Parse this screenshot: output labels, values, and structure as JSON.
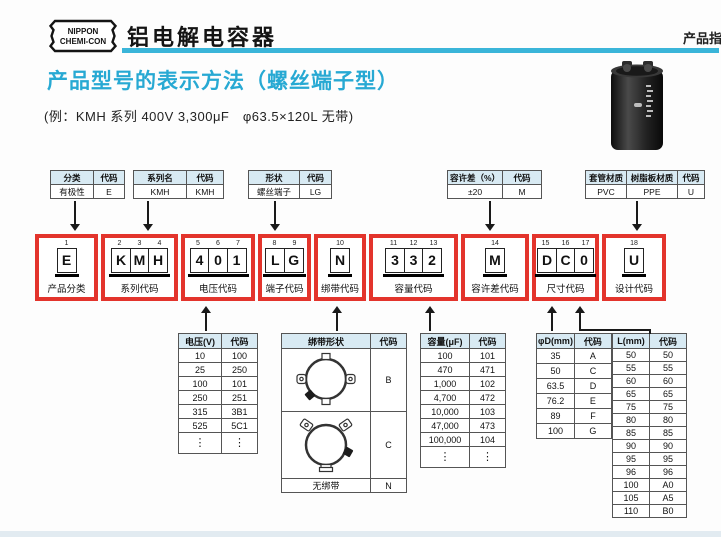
{
  "header": {
    "logo_line1": "NIPPON",
    "logo_line2": "CHEMI-CON",
    "title": "铝电解电容器",
    "corner_text": "产品指"
  },
  "section": {
    "title": "产品型号的表示方法（螺丝端子型）",
    "example": "(例：KMH 系列 400V 3,300μF　φ63.5×120L 无带)"
  },
  "colors": {
    "accent_teal": "#3ab5d9",
    "title_cyan": "#27a9d3",
    "code_box_red": "#e3342c",
    "table_header_bg": "#d8eaf3"
  },
  "attr_tables": [
    {
      "headers": [
        "分类",
        "代码"
      ],
      "rows": [
        [
          "有极性",
          "E"
        ]
      ]
    },
    {
      "headers": [
        "系列名",
        "代码"
      ],
      "rows": [
        [
          "KMH",
          "KMH"
        ]
      ]
    },
    {
      "headers": [
        "形状",
        "代码"
      ],
      "rows": [
        [
          "螺丝端子",
          "LG"
        ]
      ]
    },
    {
      "headers": [
        "容许差（%）",
        "代码"
      ],
      "rows": [
        [
          "±20",
          "M"
        ]
      ]
    },
    {
      "headers": [
        "套管材质",
        "树脂板材质",
        "代码"
      ],
      "rows": [
        [
          "PVC",
          "PPE",
          "U"
        ]
      ]
    }
  ],
  "code_boxes": [
    {
      "positions": [
        "1"
      ],
      "chars": [
        "E"
      ],
      "label": "产品分类"
    },
    {
      "positions": [
        "2",
        "3",
        "4"
      ],
      "chars": [
        "K",
        "M",
        "H"
      ],
      "label": "系列代码"
    },
    {
      "positions": [
        "5",
        "6",
        "7"
      ],
      "chars": [
        "4",
        "0",
        "1"
      ],
      "label": "电压代码"
    },
    {
      "positions": [
        "8",
        "9"
      ],
      "chars": [
        "L",
        "G"
      ],
      "label": "端子代码"
    },
    {
      "positions": [
        "10"
      ],
      "chars": [
        "N"
      ],
      "label": "绑带代码"
    },
    {
      "positions": [
        "11",
        "12",
        "13"
      ],
      "chars": [
        "3",
        "3",
        "2"
      ],
      "label": "容量代码"
    },
    {
      "positions": [
        "14"
      ],
      "chars": [
        "M"
      ],
      "label": "容许差代码"
    },
    {
      "positions": [
        "15",
        "16",
        "17"
      ],
      "chars": [
        "D",
        "C",
        "0"
      ],
      "label": "尺寸代码"
    },
    {
      "positions": [
        "18"
      ],
      "chars": [
        "U"
      ],
      "label": "设计代码"
    }
  ],
  "voltage_table": {
    "headers": [
      "电压(V)",
      "代码"
    ],
    "rows": [
      [
        "10",
        "100"
      ],
      [
        "25",
        "250"
      ],
      [
        "100",
        "101"
      ],
      [
        "250",
        "251"
      ],
      [
        "315",
        "3B1"
      ],
      [
        "525",
        "5C1"
      ],
      [
        "⋮",
        "⋮"
      ]
    ]
  },
  "band_table": {
    "headers": [
      "绑带形状",
      "代码"
    ],
    "rows": [
      [
        "@tpl-band-b",
        "B"
      ],
      [
        "@tpl-band-c",
        "C"
      ],
      [
        "无绑带",
        "N"
      ]
    ]
  },
  "capacity_table": {
    "headers": [
      "容量(μF)",
      "代码"
    ],
    "rows": [
      [
        "100",
        "101"
      ],
      [
        "470",
        "471"
      ],
      [
        "1,000",
        "102"
      ],
      [
        "4,700",
        "472"
      ],
      [
        "10,000",
        "103"
      ],
      [
        "47,000",
        "473"
      ],
      [
        "100,000",
        "104"
      ],
      [
        "⋮",
        "⋮"
      ]
    ]
  },
  "diameter_table": {
    "headers": [
      "φD(mm)",
      "代码"
    ],
    "rows": [
      [
        "35",
        "A"
      ],
      [
        "50",
        "C"
      ],
      [
        "63.5",
        "D"
      ],
      [
        "76.2",
        "E"
      ],
      [
        "89",
        "F"
      ],
      [
        "100",
        "G"
      ]
    ]
  },
  "length_table": {
    "headers": [
      "L(mm)",
      "代码"
    ],
    "rows": [
      [
        "50",
        "50"
      ],
      [
        "55",
        "55"
      ],
      [
        "60",
        "60"
      ],
      [
        "65",
        "65"
      ],
      [
        "75",
        "75"
      ],
      [
        "80",
        "80"
      ],
      [
        "85",
        "85"
      ],
      [
        "90",
        "90"
      ],
      [
        "95",
        "95"
      ],
      [
        "96",
        "96"
      ],
      [
        "100",
        "A0"
      ],
      [
        "105",
        "A5"
      ],
      [
        "110",
        "B0"
      ]
    ]
  }
}
